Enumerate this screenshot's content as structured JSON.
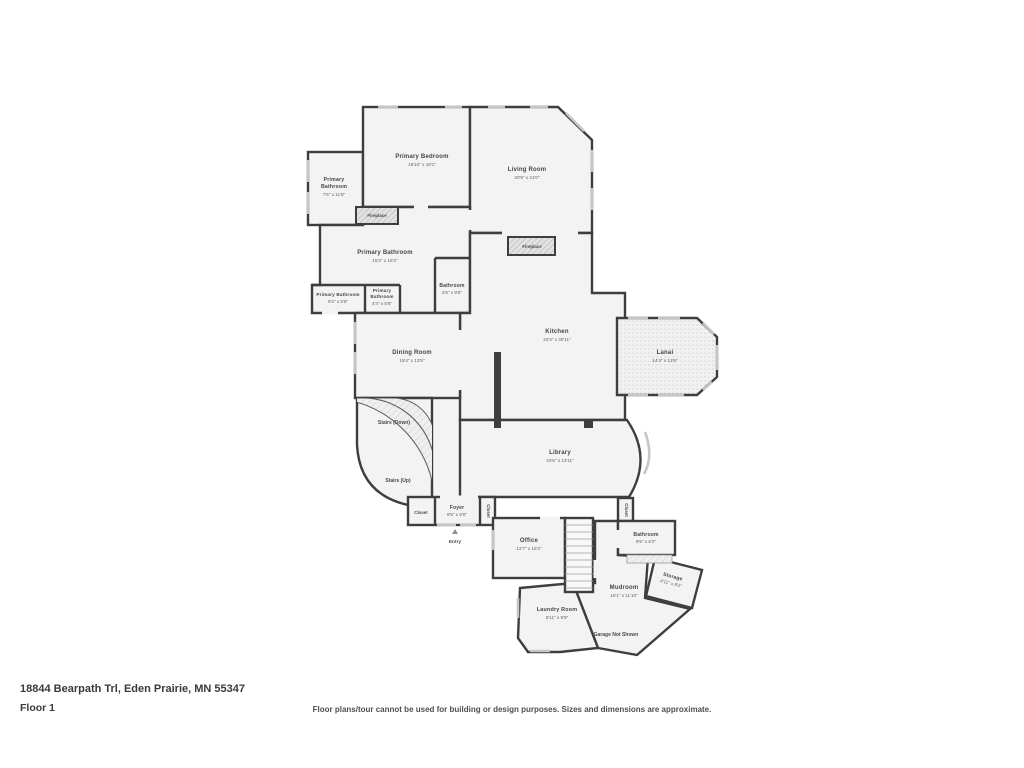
{
  "page": {
    "address": "18844 Bearpath Trl, Eden Prairie, MN 55347",
    "floor_label": "Floor 1",
    "disclaimer": "Floor plans/tour cannot be used for building or design purposes. Sizes and dimensions are approximate."
  },
  "colors": {
    "wall": "#3e3e3e",
    "room_fill": "#f3f3f3",
    "window": "#c6c6c6",
    "label_text": "#454545"
  },
  "rooms": {
    "primary_bathroom_tl": {
      "line1": "Primary",
      "line2": "Bathroom",
      "dims": "7'6\" x 11'8\""
    },
    "primary_bedroom": {
      "label": "Primary Bedroom",
      "dims": "18'10\" x 18'1\""
    },
    "living_room": {
      "label": "Living Room",
      "dims": "20'9\" x 21'0\""
    },
    "fireplace_bedroom": {
      "label": "Fireplace"
    },
    "fireplace_living": {
      "label": "Fireplace"
    },
    "primary_bathroom_main": {
      "label": "Primary Bathroom",
      "dims": "15'2\" x 16'3\""
    },
    "bathroom_upper": {
      "label": "Bathroom",
      "dims": "5'5\" x 9'6\""
    },
    "primary_bathroom_left": {
      "label": "Primary Bathroom",
      "dims": "9'2\" x 5'8\""
    },
    "primary_bathroom_mid": {
      "line1": "Primary",
      "line2": "Bathroom",
      "dims": "4'4\" x 5'8\""
    },
    "kitchen": {
      "label": "Kitchen",
      "dims": "22'3\" x 30'11\""
    },
    "dining_room": {
      "label": "Dining Room",
      "dims": "19'4\" x 13'5\""
    },
    "lanai": {
      "label": "Lanai",
      "dims": "14'4\" x 12'8\""
    },
    "stairs_down": {
      "label": "Stairs (Down)"
    },
    "stairs_up": {
      "label": "Stairs (Up)"
    },
    "library": {
      "label": "Library",
      "dims": "24'5\" x 13'11\""
    },
    "closet_foyer_left": {
      "label": "Closet"
    },
    "foyer": {
      "label": "Foyer",
      "dims": "8'5\" x 6'8\""
    },
    "closet_foyer_right": {
      "label": "Closet"
    },
    "entry": {
      "label": "Entry"
    },
    "office": {
      "label": "Office",
      "dims": "12'7\" x 15'3\""
    },
    "closet_hall": {
      "label": "Closet"
    },
    "bathroom_lower": {
      "label": "Bathroom",
      "dims": "9'5\" x 6'2\""
    },
    "storage": {
      "label": "Storage",
      "dims": "4'11\" x 8'2\""
    },
    "mudroom": {
      "label": "Mudroom",
      "dims": "16'1\" x 11'10\""
    },
    "laundry_room": {
      "label": "Laundry Room",
      "dims": "8'11\" x 9'9\""
    },
    "garage_note": {
      "label": "Garage Not Shown"
    }
  }
}
